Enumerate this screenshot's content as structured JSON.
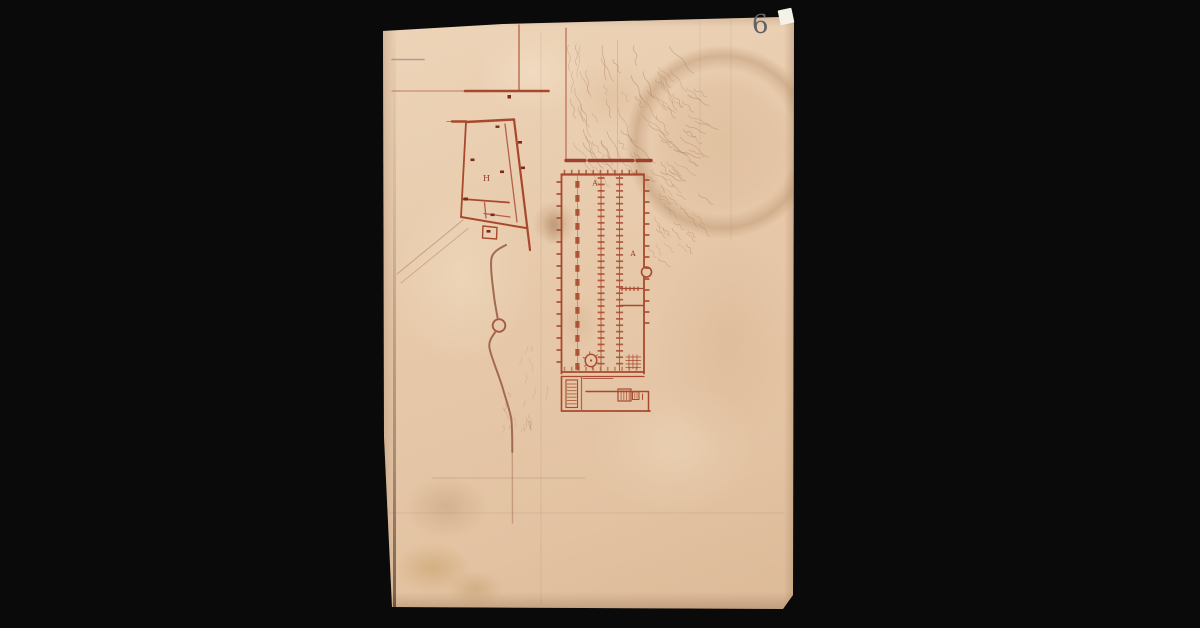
{
  "viewer": {
    "background_color": "#0a0a0a"
  },
  "page": {
    "number": "6",
    "labels": {
      "left_building": "H",
      "main_hall_upper": "A",
      "main_hall_lower": "A"
    },
    "colors": {
      "paper": "#e8cbac",
      "ink": "#a8492e",
      "ink_dark": "#7c2b1b",
      "ink_light": "#c07a5f",
      "road": "#a26a50",
      "terrain": "#a97c58",
      "pencil": "#8d7b68",
      "page_number": "#5f6368",
      "background": "#0a0a0a"
    }
  }
}
